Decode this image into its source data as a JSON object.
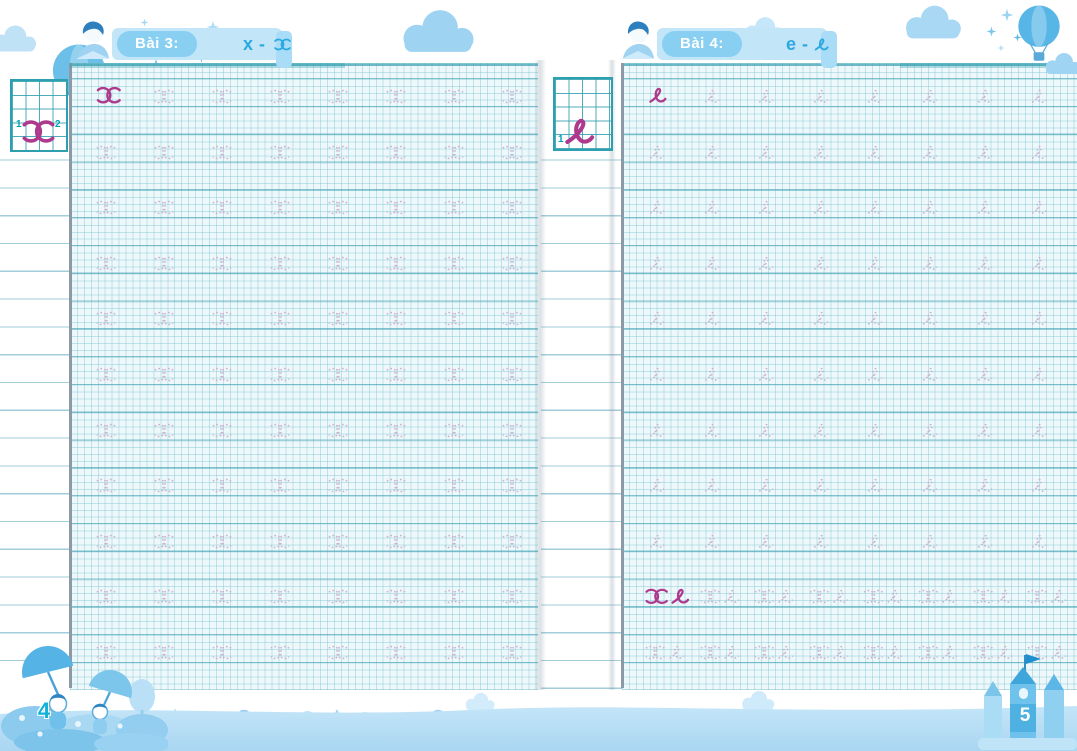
{
  "workbook": {
    "left_page": {
      "lesson_label": "Bài 3:",
      "lesson_print_letter": "x",
      "separator": "-",
      "cursive_letter_name": "cursive x",
      "page_number": "4",
      "stroke_numbers": [
        "1",
        "2"
      ],
      "practice_sections": [
        {
          "glyph": "x",
          "rows": 11,
          "cols": 8,
          "first_solid": true
        }
      ]
    },
    "right_page": {
      "lesson_label": "Bài 4:",
      "lesson_print_letter": "e",
      "separator": "-",
      "cursive_letter_name": "cursive e",
      "page_number": "5",
      "stroke_numbers": [
        "1"
      ],
      "practice_sections": [
        {
          "glyph": "e",
          "rows": 9,
          "cols": 8,
          "first_solid": true
        },
        {
          "glyph": "xe",
          "rows": 2,
          "cols": 8,
          "first_solid": true
        }
      ]
    },
    "colors": {
      "solid_letter": "#ad3a8c",
      "dotted_letter": "#ccb2cc",
      "grid_accent_line": "#2a94aa",
      "banner_pill": "#88cff2",
      "lesson_text": "#2ba9e0",
      "stroke_number": "#00a3b4",
      "page_number_left": "#12b2d8",
      "page_number_right": "#ffffff"
    }
  }
}
